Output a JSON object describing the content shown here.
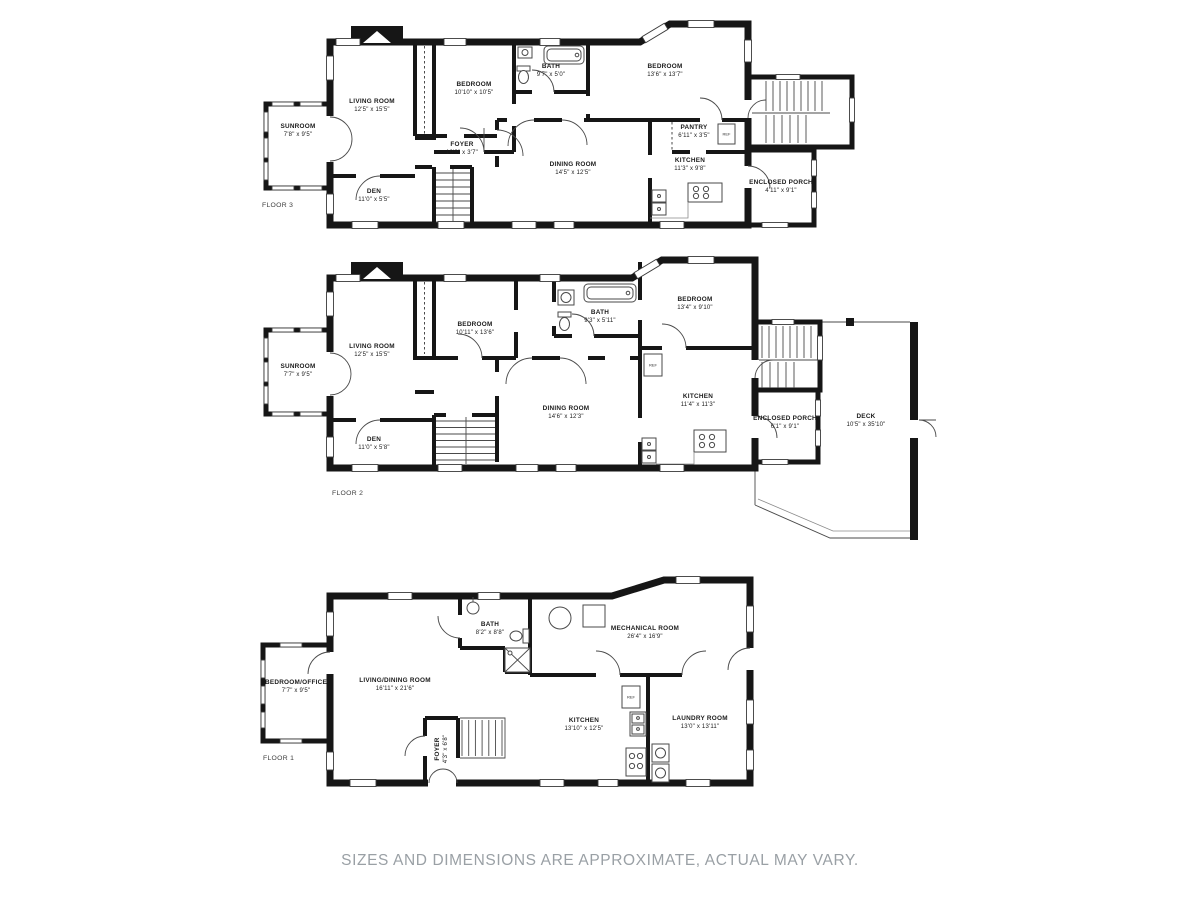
{
  "caption": "SIZES AND DIMENSIONS ARE APPROXIMATE, ACTUAL MAY VARY.",
  "colors": {
    "wall": "#161616",
    "label_ink": "#1b1b1b",
    "caption_gray": "#9aa0a5"
  },
  "fixtures": {
    "ref_label": "REF"
  },
  "floors": [
    {
      "label": "FLOOR 3",
      "rooms": [
        {
          "name": "SUNROOM",
          "dims": "7'8\" x 9'5\""
        },
        {
          "name": "LIVING ROOM",
          "dims": "12'5\" x 15'5\""
        },
        {
          "name": "DEN",
          "dims": "11'0\" x 5'5\""
        },
        {
          "name": "BEDROOM",
          "dims": "10'10\" x 10'5\""
        },
        {
          "name": "FOYER",
          "dims": "10'9\" x 3'7\""
        },
        {
          "name": "BATH",
          "dims": "9'7\" x 5'0\""
        },
        {
          "name": "BEDROOM",
          "dims": "13'6\" x 13'7\""
        },
        {
          "name": "DINING ROOM",
          "dims": "14'5\" x 12'5\""
        },
        {
          "name": "PANTRY",
          "dims": "6'11\" x 3'5\""
        },
        {
          "name": "KITCHEN",
          "dims": "11'3\" x 9'8\""
        },
        {
          "name": "ENCLOSED PORCH",
          "dims": "4'11\" x 9'1\""
        }
      ]
    },
    {
      "label": "FLOOR 2",
      "rooms": [
        {
          "name": "SUNROOM",
          "dims": "7'7\" x 9'5\""
        },
        {
          "name": "LIVING ROOM",
          "dims": "12'5\" x 15'5\""
        },
        {
          "name": "DEN",
          "dims": "11'0\" x 5'8\""
        },
        {
          "name": "BEDROOM",
          "dims": "10'11\" x 13'6\""
        },
        {
          "name": "BATH",
          "dims": "9'3\" x 5'11\""
        },
        {
          "name": "BEDROOM",
          "dims": "13'4\" x 9'10\""
        },
        {
          "name": "DINING ROOM",
          "dims": "14'6\" x 12'3\""
        },
        {
          "name": "KITCHEN",
          "dims": "11'4\" x 11'3\""
        },
        {
          "name": "ENCLOSED PORCH",
          "dims": "6'1\" x 9'1\""
        },
        {
          "name": "DECK",
          "dims": "10'5\" x 35'10\""
        }
      ]
    },
    {
      "label": "FLOOR 1",
      "rooms": [
        {
          "name": "BEDROOM/OFFICE",
          "dims": "7'7\" x 9'5\""
        },
        {
          "name": "LIVING/DINING ROOM",
          "dims": "16'11\" x 21'6\""
        },
        {
          "name": "BATH",
          "dims": "8'2\" x 8'8\""
        },
        {
          "name": "MECHANICAL ROOM",
          "dims": "26'4\" x 16'9\""
        },
        {
          "name": "FOYER",
          "dims": "4'3\" x 6'8\""
        },
        {
          "name": "KITCHEN",
          "dims": "13'10\" x 12'5\""
        },
        {
          "name": "LAUNDRY ROOM",
          "dims": "13'0\" x 13'11\""
        }
      ]
    }
  ]
}
